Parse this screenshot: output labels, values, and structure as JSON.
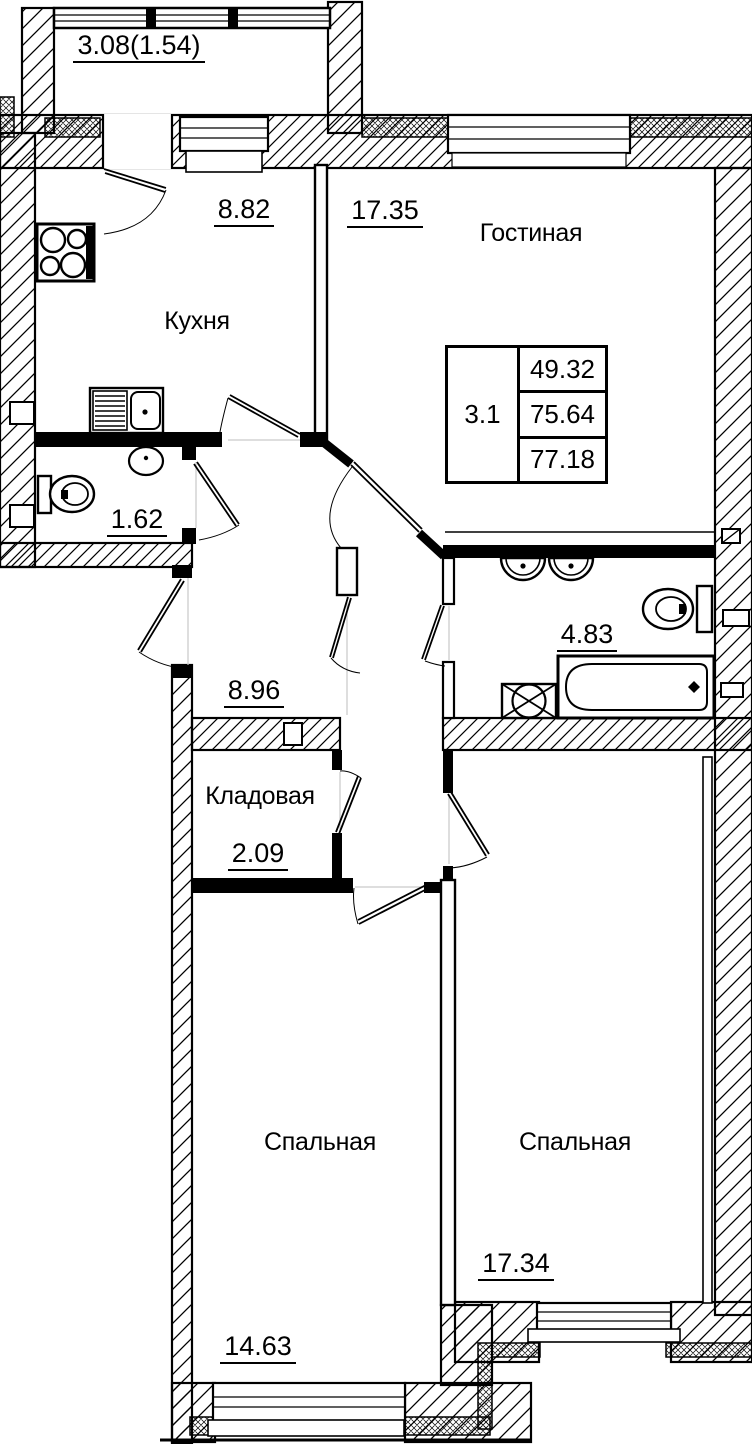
{
  "rooms": {
    "balcony": {
      "area": "3.08(1.54)"
    },
    "kitchen": {
      "name": "Кухня",
      "area": "8.82"
    },
    "living": {
      "name": "Гостиная",
      "area": "17.35"
    },
    "wc": {
      "area": "1.62"
    },
    "hallway": {
      "area": "8.96"
    },
    "bathroom": {
      "area": "4.83"
    },
    "storage": {
      "name": "Кладовая",
      "area": "2.09"
    },
    "bedroom_left": {
      "name": "Спальная",
      "area": "14.63"
    },
    "bedroom_right": {
      "name": "Спальная",
      "area": "17.34"
    }
  },
  "info_table": {
    "apartment_number": "3.1",
    "rows": [
      "49.32",
      "75.64",
      "77.18"
    ]
  },
  "fixtures": [
    "stove",
    "kitchen-sink",
    "washbasin",
    "toilet",
    "double-washbasin",
    "bathtub",
    "washing-machine"
  ],
  "colors": {
    "line": "#000000",
    "background": "#ffffff"
  }
}
